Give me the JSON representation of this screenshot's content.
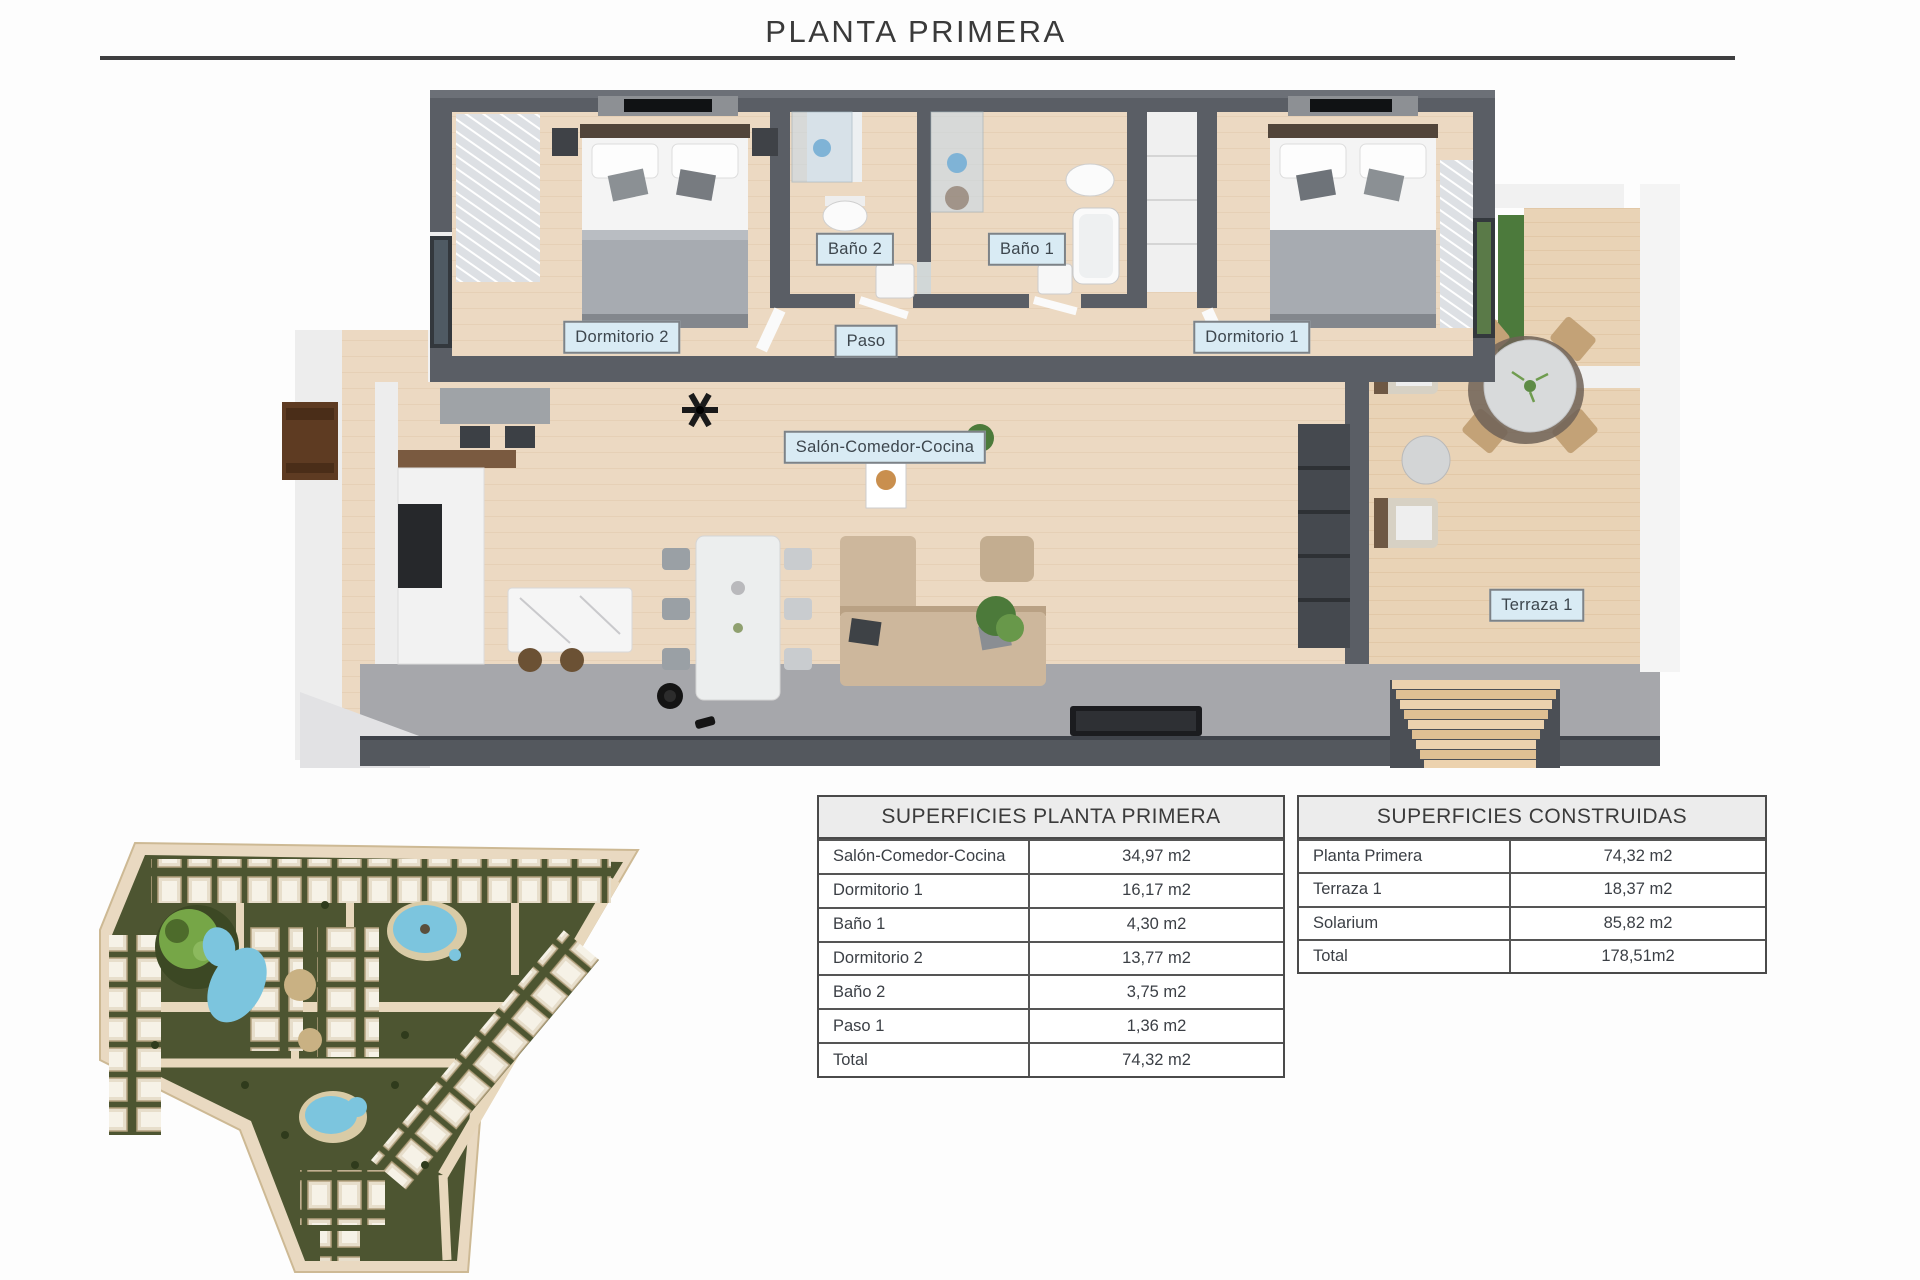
{
  "title": "PLANTA PRIMERA",
  "floor_plan": {
    "labels": {
      "bano2": "Baño 2",
      "bano1": "Baño 1",
      "dormitorio2": "Dormitorio 2",
      "paso": "Paso",
      "dormitorio1": "Dormitorio 1",
      "salon": "Salón-Comedor-Cocina",
      "terraza1": "Terraza 1"
    }
  },
  "tables": [
    {
      "title": "SUPERFICIES PLANTA PRIMERA",
      "rows": [
        {
          "label": "Salón-Comedor-Cocina",
          "value": "34,97 m2"
        },
        {
          "label": "Dormitorio 1",
          "value": "16,17 m2"
        },
        {
          "label": "Baño 1",
          "value": "4,30 m2"
        },
        {
          "label": "Dormitorio 2",
          "value": "13,77 m2"
        },
        {
          "label": "Baño 2",
          "value": "3,75 m2"
        },
        {
          "label": "Paso 1",
          "value": "1,36 m2"
        },
        {
          "label": "Total",
          "value": "74,32 m2"
        }
      ]
    },
    {
      "title": "SUPERFICIES CONSTRUIDAS",
      "rows": [
        {
          "label": "Planta Primera",
          "value": "74,32 m2"
        },
        {
          "label": "Terraza 1",
          "value": "18,37 m2"
        },
        {
          "label": "Solarium",
          "value": "85,82 m2"
        },
        {
          "label": "Total",
          "value": "178,51m2"
        }
      ]
    }
  ],
  "colors": {
    "wall": "#5a5e65",
    "wood_floor": "#ecd9c2",
    "outdoor_floor": "#a6a7ab",
    "label_bg": "#d9ebf4",
    "label_border": "#7d8287",
    "pool": "#7cc5de",
    "site_green": "#4d5531",
    "site_beige": "#e9d9c1",
    "rule": "#3e3e40"
  }
}
